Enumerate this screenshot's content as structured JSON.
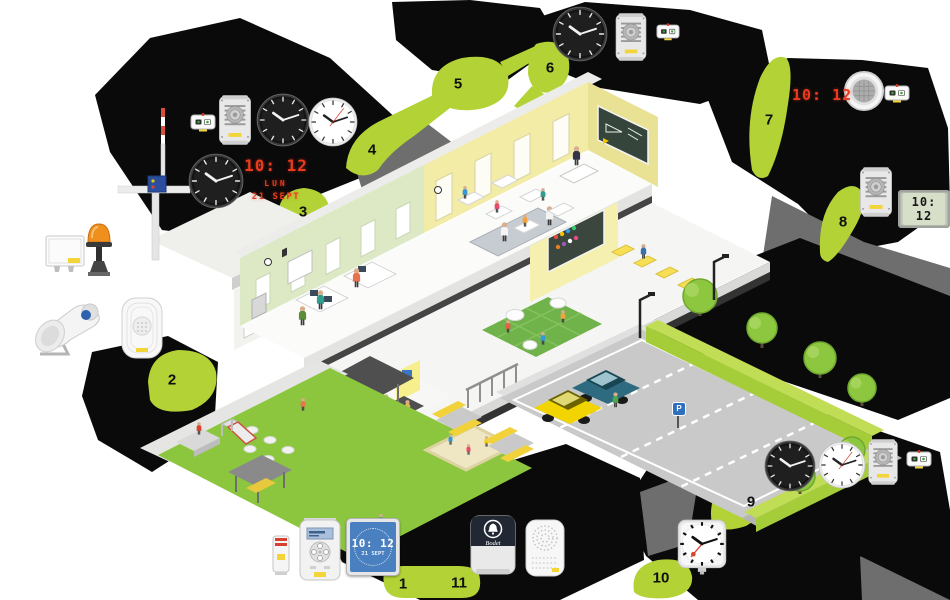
{
  "brand": "Bodet",
  "badges": [
    {
      "label": "1"
    },
    {
      "label": "2"
    },
    {
      "label": "3"
    },
    {
      "label": "4"
    },
    {
      "label": "5"
    },
    {
      "label": "6"
    },
    {
      "label": "7"
    },
    {
      "label": "8"
    },
    {
      "label": "9"
    },
    {
      "label": "10"
    },
    {
      "label": "11"
    }
  ],
  "displays": {
    "led_time": "10: 12",
    "led_day": "LUN",
    "led_date": "21 SEPT",
    "led_wall_time": "10: 12",
    "lcd_time": "10: 12",
    "lcd_blue_time": "10: 12",
    "lcd_blue_date": "21 SEPT",
    "analog_time": "10:12"
  },
  "parking": {
    "sign": "P"
  },
  "analog_clock_numerals": [
    "12",
    "1",
    "2",
    "3",
    "4",
    "5",
    "6",
    "7",
    "8",
    "9",
    "10",
    "11"
  ]
}
